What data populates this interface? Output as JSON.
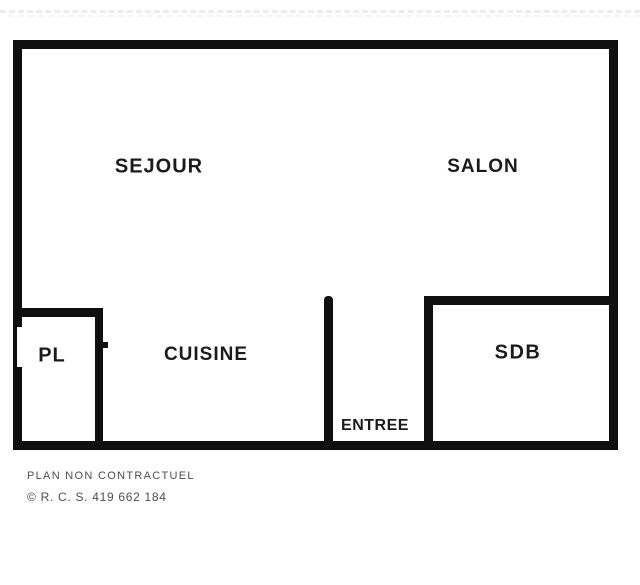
{
  "plan": {
    "rooms": {
      "sejour": "SEJOUR",
      "salon": "SALON",
      "pl": "PL",
      "cuisine": "CUISINE",
      "sdb": "SDB",
      "entree": "ENTREE"
    }
  },
  "footer": {
    "disclaimer": "PLAN NON CONTRACTUEL",
    "rcs": "© R. C. S. 419 662 184"
  },
  "colors": {
    "wall": "#0f0f0f",
    "room_label": "#1b1b1b",
    "footer_text": "#4e4e4e",
    "background": "#ffffff",
    "top_line": "#ececec"
  }
}
